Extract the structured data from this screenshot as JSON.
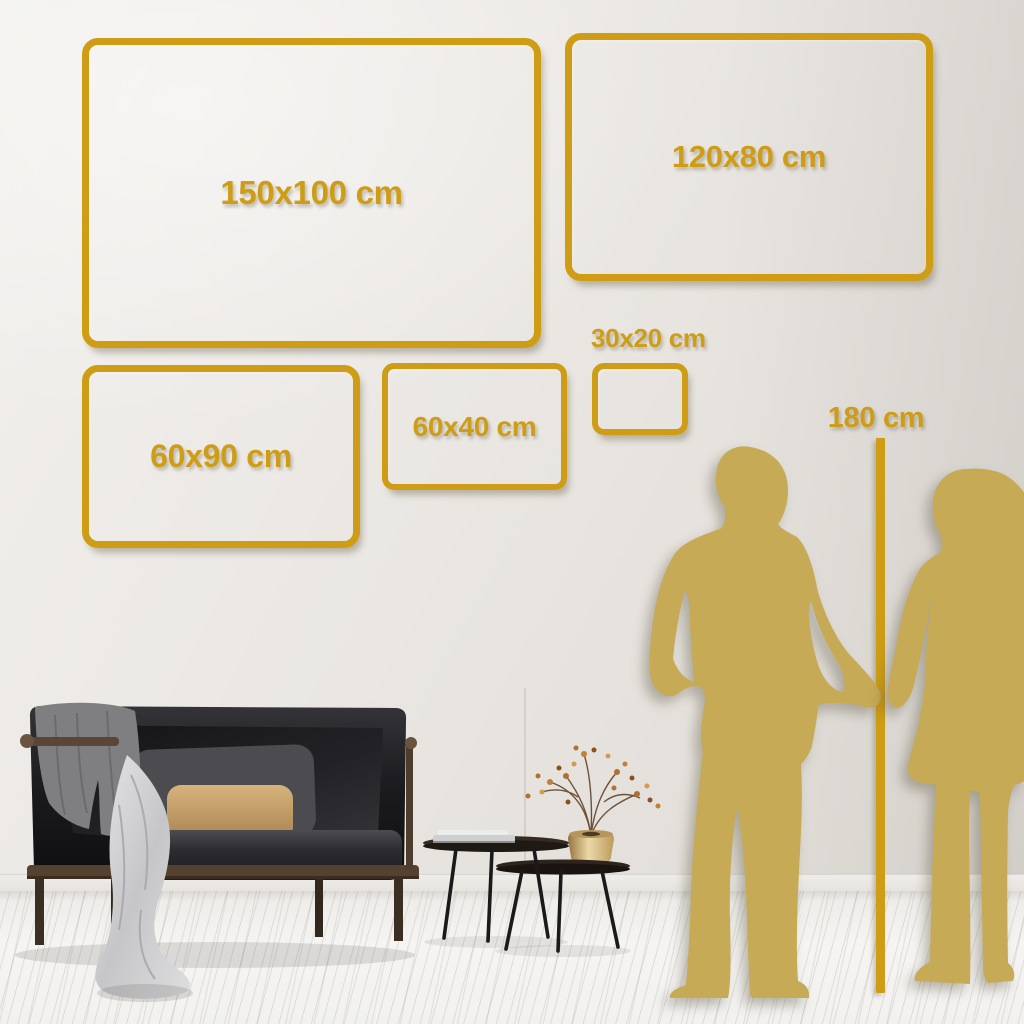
{
  "title": "Wall art size comparison guide",
  "frames": [
    {
      "id": "150x100",
      "label": "150x100 cm"
    },
    {
      "id": "120x80",
      "label": "120x80 cm"
    },
    {
      "id": "60x90",
      "label": "60x90 cm"
    },
    {
      "id": "60x40",
      "label": "60x40 cm"
    },
    {
      "id": "30x20",
      "label": "30x20 cm"
    }
  ],
  "ruler": {
    "label": "180 cm"
  },
  "colors": {
    "frame_gold": "#CE9D15",
    "silhouette_gold": "#C6AA56",
    "wall_light": "#F2F0ED",
    "wall_dark": "#DCD8D2",
    "floor": "#F3F2F0",
    "sofa_dark": "#19191c",
    "pillow_tan": "#CBA56E",
    "blanket_gray": "#7F7F82"
  },
  "icons": {
    "man": "man-silhouette",
    "woman": "woman-silhouette",
    "sofa": "sofa",
    "tables": "coffee-tables",
    "plant": "vase-with-dried-plant"
  }
}
